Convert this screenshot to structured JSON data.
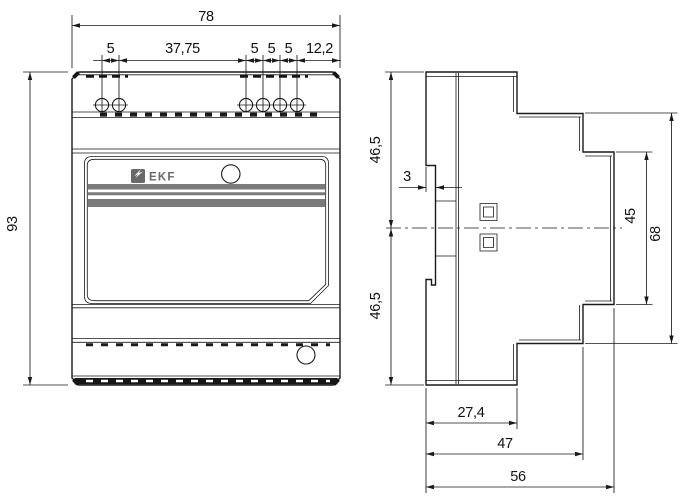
{
  "front_view": {
    "overall_width": "78",
    "top_segments": [
      "5",
      "37,75",
      "5",
      "5",
      "5",
      "12,2"
    ],
    "overall_height": "93",
    "brand": "EKF"
  },
  "side_view": {
    "upper_half_height": "46,5",
    "lower_half_height": "46,5",
    "rail_recess_depth": "3",
    "front_panel_height": "45",
    "body_step_height": "68",
    "depth_step_1": "27,4",
    "depth_step_2": "47",
    "overall_depth": "56"
  },
  "colors": {
    "line": "#1a1a1a",
    "stripe": "#7a7a7a",
    "brand_gray": "#696969"
  }
}
